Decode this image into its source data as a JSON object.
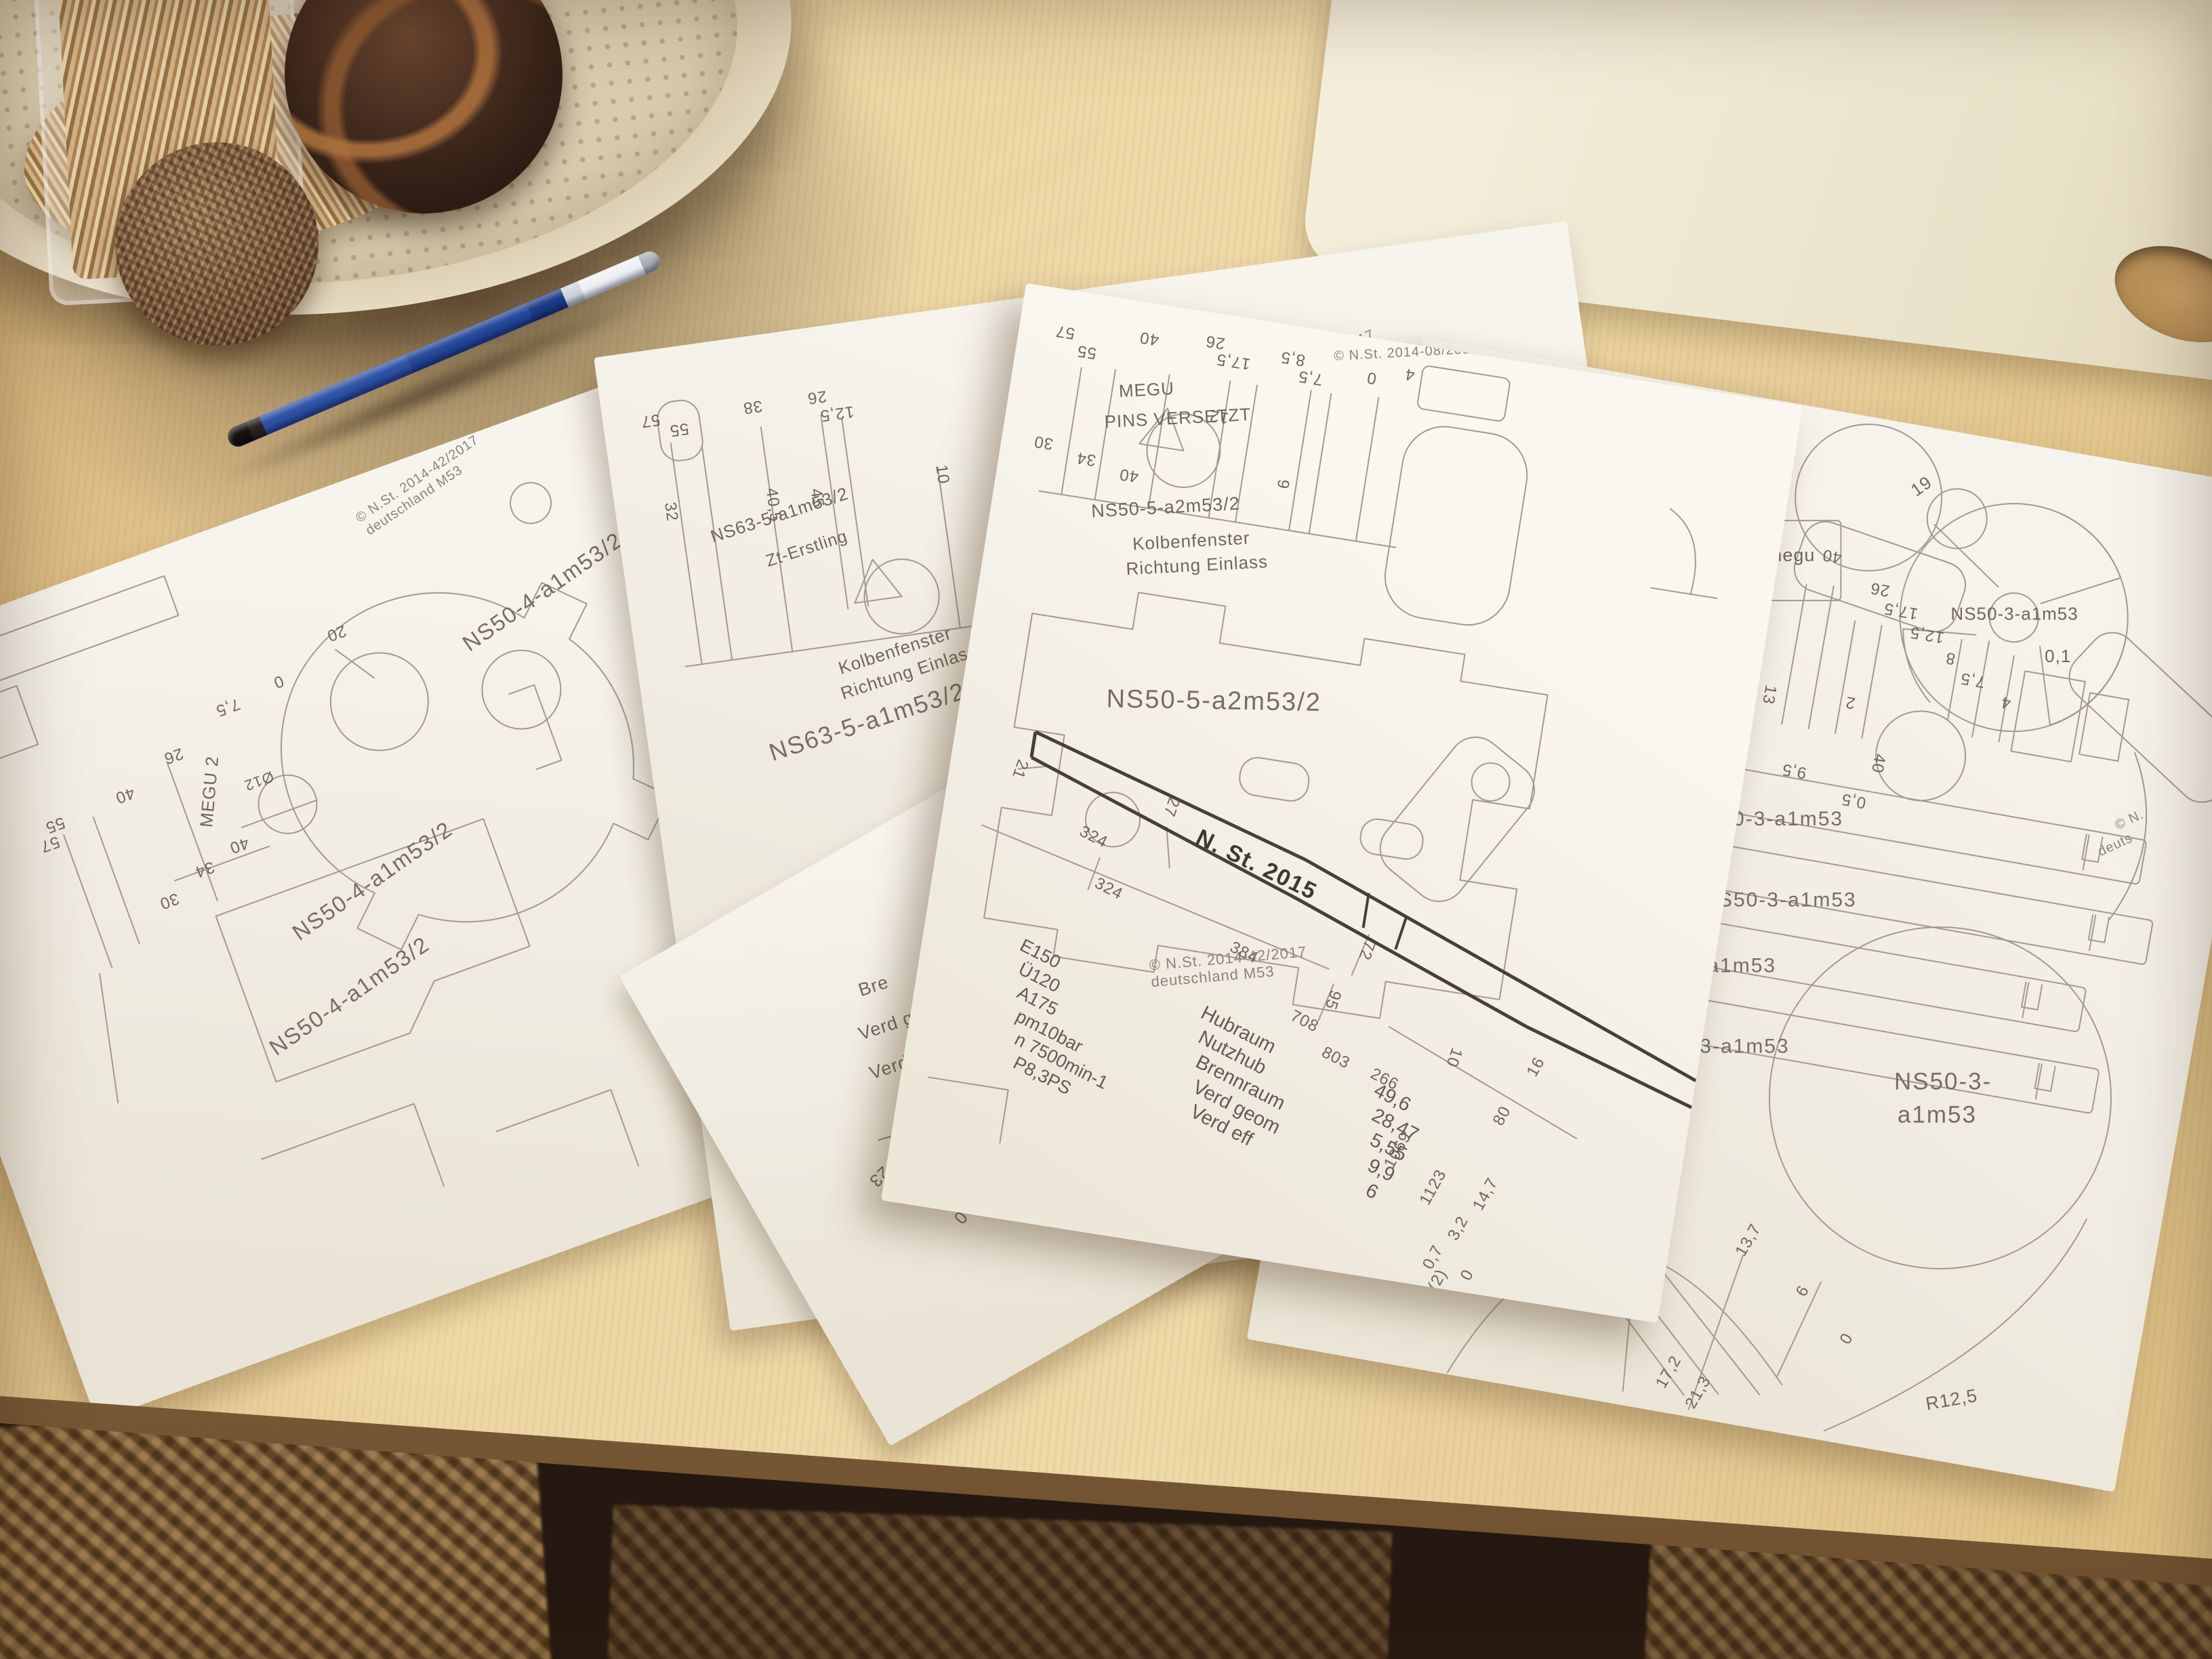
{
  "scene": {
    "desk_color": "#ecd6a4",
    "paper_color": "#f6f3ec",
    "line_color": "#a29a91",
    "pen_blue": "#2d52a6"
  },
  "papers": {
    "p1": {
      "copyright_line1": "© N.St. 2014-42/2017",
      "copyright_line2": "deutschland M53",
      "label_a": "NS50-4-a1m53/2",
      "label_b": "NS50-4-a1m53/2",
      "label_c": "NS50-4-a1m53/2",
      "megu": "MEGU 2",
      "diameter": "Ø12",
      "dims": [
        "20",
        "0",
        "7,5",
        "26",
        "40",
        "55",
        "57",
        "40",
        "34",
        "30"
      ]
    },
    "p2": {
      "copyright_line1": "© N.St. 2014-08/2017",
      "copyright_line2": "deutschland M53",
      "title": "NS63-5-a1m53/2",
      "subtitle": "Zt-Erstling",
      "note_line1": "Kolbenfenster",
      "note_line2": "Richtung Einlass",
      "label_big": "NS63-5-a1m53/2",
      "dims": [
        "57",
        "55",
        "38",
        "26",
        "12,5",
        "10",
        "32",
        "40,5",
        "45"
      ]
    },
    "p3": {
      "copyright_top_line1": "© N.St. 2014-08/2017",
      "copyright_top_line2": "deutschland M53",
      "megu_line1": "MEGU",
      "megu_line2": "PINS VERSETZT",
      "pin_dim": "12",
      "label_small": "NS50-5-a2m53/2",
      "note_line1": "Kolbenfenster",
      "note_line2": "Richtung Einlass",
      "label_big": "NS50-5-a2m53/2",
      "copyright_mid_line1": "© N.St. 2014-42/2017",
      "copyright_mid_line2": "deutschland M53",
      "banner": "N. St. 2015",
      "top_dims": [
        "57",
        "55",
        "40",
        "26",
        "17,5",
        "8,5",
        "7,5",
        "0",
        "4"
      ],
      "side_dims": [
        "30",
        "34",
        "40",
        "9"
      ],
      "pipe_dims": [
        "21",
        "27",
        "324",
        "324",
        "384",
        "72",
        "95",
        "708",
        "803",
        "266",
        "10"
      ],
      "bottom_dims": [
        "16",
        "80",
        "1069",
        "1123",
        "14,7",
        "3,2",
        "0,7",
        "0",
        "(2)"
      ],
      "specs": [
        "E150",
        "Ü120",
        "A175",
        "pm10bar",
        "n 7500min-1",
        "P8,3PS"
      ],
      "table_labels": [
        "Hubraum",
        "Nutzhub",
        "Brennraum",
        "Verd geom",
        "Verd eff"
      ],
      "table_values": [
        "49,6",
        "28,47",
        "5,55",
        "9,9",
        "6"
      ]
    },
    "p4": {
      "corner_dim": "21",
      "box_line1": "NS50-3-a1",
      "box_line2": "megu",
      "box_line3": "m53",
      "note_line1": "Kolbenfenster",
      "note_line2": "Richtung Einlass",
      "part_labels": [
        "NS50-3-a1m53",
        "NS50-3-a1m53",
        "NS50-3-a1m53",
        "NS50-3-a1m53",
        "NS50-3-a1m53"
      ],
      "prop_label": "NS50-3-a1m53",
      "prop_tol": "0,1",
      "prop_dim": "19",
      "circle_line1": "NS50-3-",
      "circle_line2": "a1m53",
      "radius_dim": "R12,5",
      "copyright_part1": "© N.",
      "copyright_part2": "deuts",
      "top_dims": [
        "57",
        "55",
        "40",
        "26",
        "17,5",
        "12,5",
        "8",
        "7,5",
        "4",
        "34",
        "30",
        "13",
        "2",
        "40",
        "9,5",
        "0,5"
      ],
      "bottom_dims": [
        "17,2",
        "21,3",
        "13,7",
        "6",
        "0"
      ]
    },
    "p5": {
      "partial_lines": [
        "Bre",
        "Verd g",
        "Verd eff"
      ],
      "list_lines": [
        "Hubra",
        "Nutzhub",
        "Brennraum",
        "Verd geom",
        "Verd eff"
      ],
      "dims": [
        "23",
        "0"
      ]
    }
  }
}
